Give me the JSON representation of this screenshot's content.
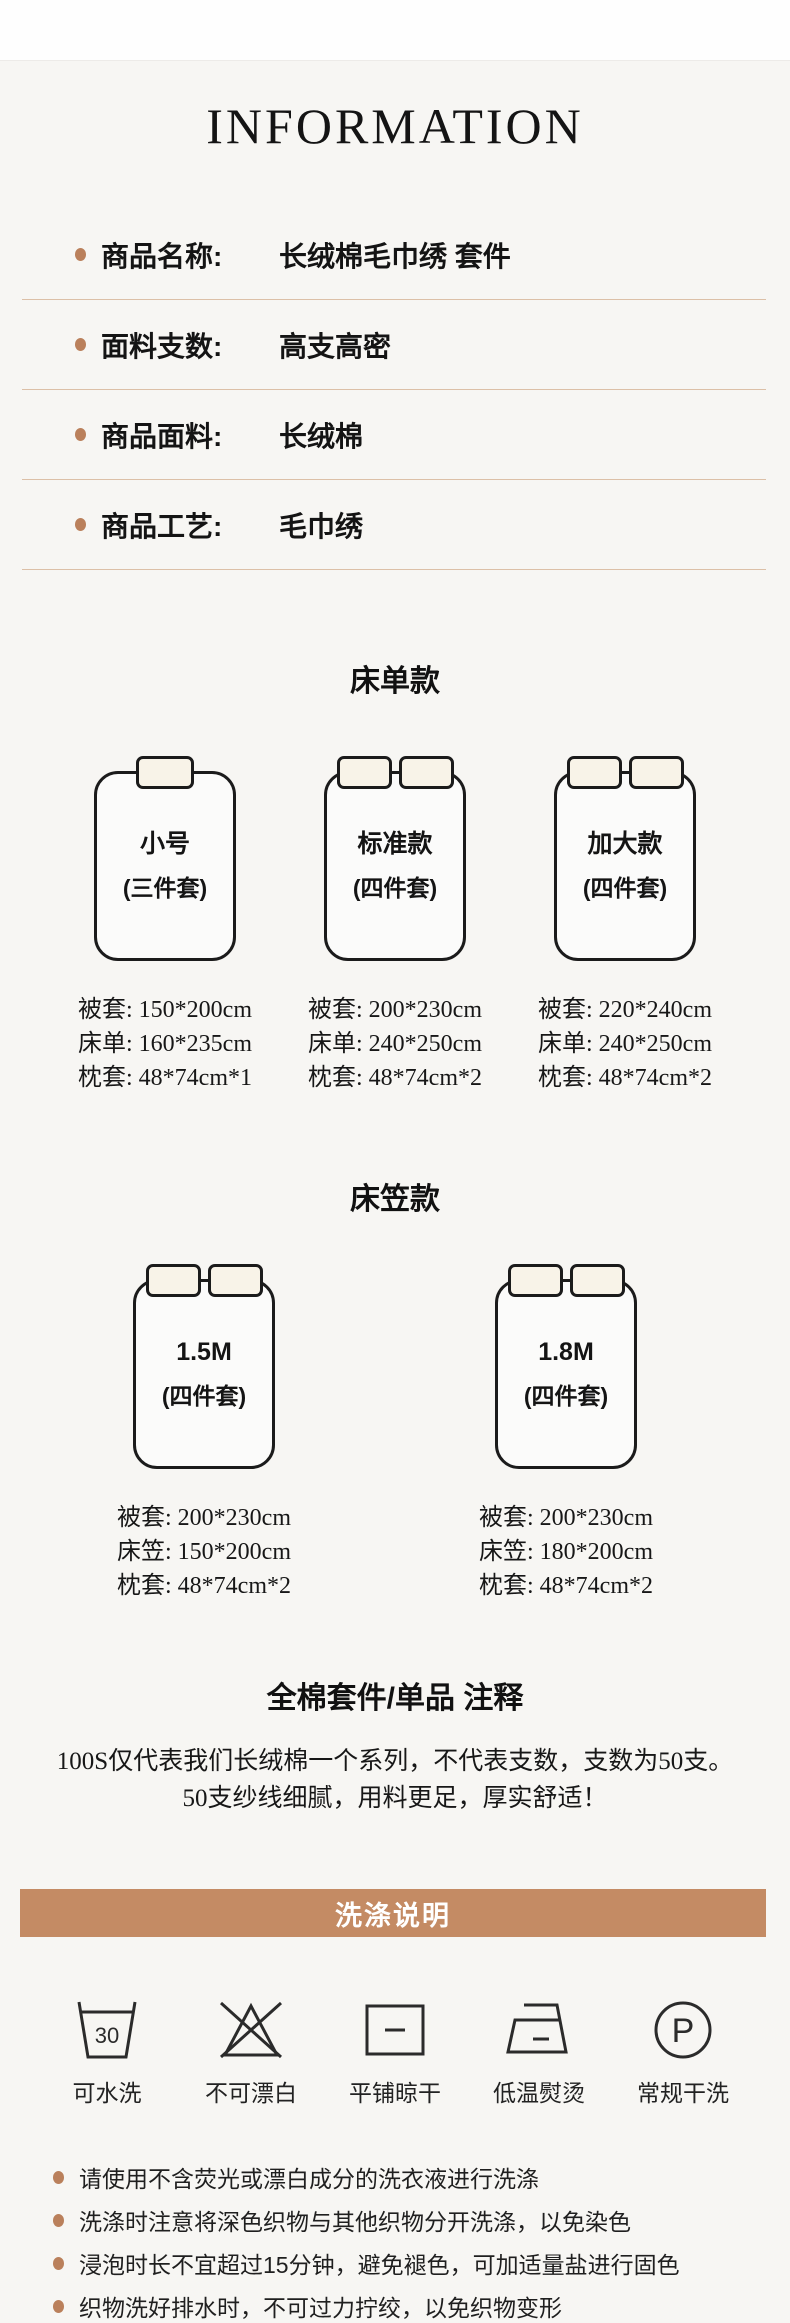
{
  "page": {
    "title": "INFORMATION"
  },
  "product_info": {
    "rows": [
      {
        "label": "商品名称:",
        "value": "长绒棉毛巾绣 套件"
      },
      {
        "label": "面料支数:",
        "value": "高支高密"
      },
      {
        "label": "商品面料:",
        "value": "长绒棉"
      },
      {
        "label": "商品工艺:",
        "value": "毛巾绣"
      }
    ]
  },
  "sections": [
    {
      "heading": "床单款",
      "beds": [
        {
          "pillows": 1,
          "name": "小号",
          "pieces": "(三件套)",
          "specs": [
            "被套: 150*200cm",
            "床单: 160*235cm",
            "枕套: 48*74cm*1"
          ]
        },
        {
          "pillows": 2,
          "name": "标准款",
          "pieces": "(四件套)",
          "specs": [
            "被套: 200*230cm",
            "床单: 240*250cm",
            "枕套: 48*74cm*2"
          ]
        },
        {
          "pillows": 2,
          "name": "加大款",
          "pieces": "(四件套)",
          "specs": [
            "被套: 220*240cm",
            "床单: 240*250cm",
            "枕套: 48*74cm*2"
          ]
        }
      ]
    },
    {
      "heading": "床笠款",
      "beds": [
        {
          "pillows": 2,
          "name": "1.5M",
          "pieces": "(四件套)",
          "specs": [
            "被套: 200*230cm",
            "床笠: 150*200cm",
            "枕套: 48*74cm*2"
          ]
        },
        {
          "pillows": 2,
          "name": "1.8M",
          "pieces": "(四件套)",
          "specs": [
            "被套: 200*230cm",
            "床笠: 180*200cm",
            "枕套: 48*74cm*2"
          ]
        }
      ]
    }
  ],
  "note": {
    "heading": "全棉套件/单品 注释",
    "lines": [
      "100S仅代表我们长绒棉一个系列，不代表支数，支数为50支。",
      "50支纱线细腻，用料更足，厚实舒适！"
    ]
  },
  "washing": {
    "banner": "洗涤说明",
    "icons": [
      {
        "name": "wash-30-icon",
        "label": "可水洗",
        "value": "30"
      },
      {
        "name": "no-bleach-icon",
        "label": "不可漂白"
      },
      {
        "name": "flat-dry-icon",
        "label": "平铺晾干"
      },
      {
        "name": "iron-low-icon",
        "label": "低温熨烫"
      },
      {
        "name": "dry-clean-p-icon",
        "label": "常规干洗",
        "value": "P"
      }
    ],
    "tips": [
      "请使用不含荧光或漂白成分的洗衣液进行洗涤",
      "洗涤时注意将深色织物与其他织物分开洗涤，以免染色",
      "浸泡时长不宜超过15分钟，避免褪色，可加适量盐进行固色",
      "织物洗好排水时，不可过力拧绞，以免织物变形"
    ]
  },
  "colors": {
    "background": "#f7f6f3",
    "accent_brown": "#c48b64",
    "divider": "#dcc0a7",
    "bullet": "#ba805b",
    "pillow_fill": "#f8f3e8",
    "text": "#1a1a1a"
  }
}
